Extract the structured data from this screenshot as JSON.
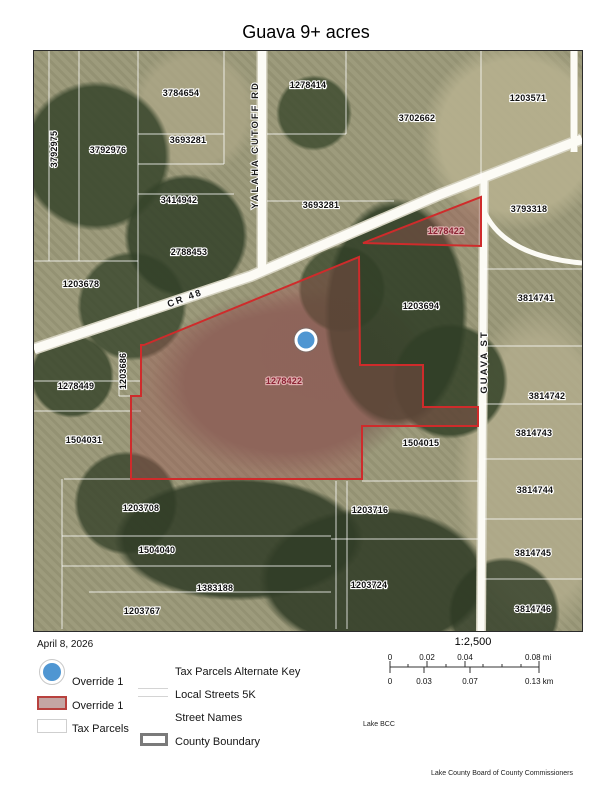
{
  "title": "Guava 9+ acres",
  "date": "April 8, 2026",
  "legend": {
    "override_point": "Override 1",
    "override_poly": "Override 1",
    "tax_parcels": "Tax Parcels",
    "alt_key": "Tax Parcels Alternate Key",
    "local_streets": "Local Streets 5K",
    "street_names": "Street Names",
    "county_boundary": "County Boundary"
  },
  "scale": {
    "ratio": "1:2,500",
    "mi": [
      "0",
      "0.02",
      "0.04",
      "0.08 mi"
    ],
    "km": [
      "0",
      "0.03",
      "0.07",
      "0.13 km"
    ]
  },
  "credits": {
    "small": "Lake BCC",
    "bottom": "Lake County Board of County Commissioners"
  },
  "colors": {
    "override_red": "#cf2b2b",
    "override_fill": "rgba(158,82,82,0.38)",
    "marker_blue": "#4f96d2",
    "label_red": "#8c2434"
  },
  "map": {
    "marker": {
      "cx": 272,
      "cy": 289
    },
    "override_polygons": [
      {
        "id": "main",
        "points": "110,294 325,206 326,314 389,314 389,356 444,356 444,375 328,375 328,428 97,428 97,345 107,345 107,294"
      },
      {
        "id": "triangle",
        "points": "329,192 447,146 447,195"
      }
    ],
    "parcel_labels": [
      {
        "t": "3792975",
        "x": 23,
        "y": 98,
        "r": -90
      },
      {
        "t": "3792976",
        "x": 74,
        "y": 102
      },
      {
        "t": "3784654",
        "x": 147,
        "y": 45
      },
      {
        "t": "3693281",
        "x": 154,
        "y": 92
      },
      {
        "t": "3414942",
        "x": 145,
        "y": 152
      },
      {
        "t": "2788453",
        "x": 155,
        "y": 204
      },
      {
        "t": "1203678",
        "x": 47,
        "y": 236
      },
      {
        "t": "1278414",
        "x": 274,
        "y": 37
      },
      {
        "t": "3702662",
        "x": 383,
        "y": 70
      },
      {
        "t": "1203571",
        "x": 494,
        "y": 50
      },
      {
        "t": "3693281",
        "x": 287,
        "y": 157
      },
      {
        "t": "3793318",
        "x": 495,
        "y": 161
      },
      {
        "t": "1278422",
        "x": 412,
        "y": 183,
        "red": true
      },
      {
        "t": "1203694",
        "x": 387,
        "y": 258
      },
      {
        "t": "3814741",
        "x": 502,
        "y": 250
      },
      {
        "t": "1278422",
        "x": 250,
        "y": 333,
        "red": true
      },
      {
        "t": "1203686",
        "x": 92,
        "y": 320,
        "r": -90
      },
      {
        "t": "1278449",
        "x": 42,
        "y": 338
      },
      {
        "t": "1504031",
        "x": 50,
        "y": 392
      },
      {
        "t": "1504015",
        "x": 387,
        "y": 395
      },
      {
        "t": "1203708",
        "x": 107,
        "y": 460
      },
      {
        "t": "1203716",
        "x": 336,
        "y": 462
      },
      {
        "t": "1504040",
        "x": 123,
        "y": 502
      },
      {
        "t": "1383188",
        "x": 181,
        "y": 540
      },
      {
        "t": "1203724",
        "x": 335,
        "y": 537
      },
      {
        "t": "1203767",
        "x": 108,
        "y": 563
      },
      {
        "t": "3814742",
        "x": 513,
        "y": 348
      },
      {
        "t": "3814743",
        "x": 500,
        "y": 385
      },
      {
        "t": "3814744",
        "x": 501,
        "y": 442
      },
      {
        "t": "3814745",
        "x": 499,
        "y": 505
      },
      {
        "t": "3814746",
        "x": 499,
        "y": 561
      }
    ],
    "street_labels": [
      {
        "t": "YALAHA CUTOFF RD",
        "x": 224,
        "y": 94,
        "r": -90
      },
      {
        "t": "CR 48",
        "x": 152,
        "y": 250,
        "r": -20
      },
      {
        "t": "GUAVA ST",
        "x": 453,
        "y": 311,
        "r": -90
      }
    ],
    "parcel_lines": [
      "15,0,15,210",
      "45,0,45,210",
      "104,0,104,265",
      "104,83,190,83",
      "104,113,190,113",
      "190,0,190,113",
      "104,143,200,143",
      "0,210,104,210",
      "233,83,312,83",
      "312,0,312,83",
      "233,150,360,150",
      "447,0,447,128",
      "450,218,548,218",
      "450,295,548,295",
      "450,353,548,353",
      "450,408,548,408",
      "450,468,548,468",
      "450,528,548,528",
      "30,428,97,428",
      "328,430,444,430",
      "28,485,297,485",
      "28,515,297,515",
      "55,541,297,541",
      "302,430,302,578",
      "313,430,313,578",
      "297,488,444,488",
      "0,330,107,330",
      "0,360,107,360",
      "107,294,107,345",
      "85,300,85,345",
      "85,345,97,345",
      "28,428,28,578"
    ]
  }
}
